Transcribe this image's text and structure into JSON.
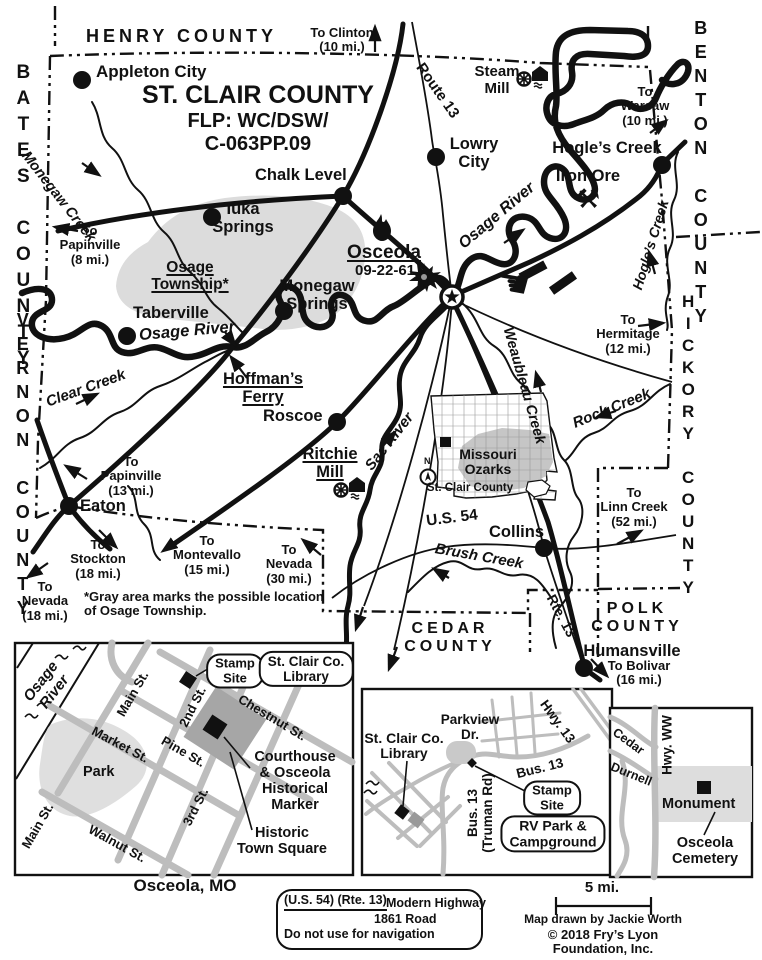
{
  "map": {
    "title": "ST. CLAIR COUNTY",
    "subtitle1": "FLP: WC/DSW/",
    "subtitle2": "C-063PP.09",
    "footnote": "*Gray area marks the possible location\nof Osage Township."
  },
  "colors": {
    "ink": "#111111",
    "township_gray": "#dcdcdc",
    "street_gray": "#bdbdbd",
    "square_gray": "#a6a6a6"
  },
  "counties": {
    "henry": "HENRY COUNTY",
    "bates": "BATES COUNTY",
    "benton": "BENTON COUNTY",
    "vernon": "VERNON COUNTY",
    "hickory": "HICKORY COUNTY",
    "cedar": "CEDAR\nCOUNTY",
    "polk": "POLK\nCOUNTY"
  },
  "towns": {
    "appleton_city": "Appleton City",
    "chalk_level": "Chalk Level",
    "lowry_city": "Lowry\nCity",
    "hogles_creek": "Hogle’s Creek",
    "iuka_springs": "Iuka\nSprings",
    "monegaw_springs": "Monegaw\nSprings",
    "taberville": "Taberville",
    "roscoe": "Roscoe",
    "eaton": "Eaton",
    "collins": "Collins",
    "humansville": "Humansville",
    "osceola": "Osceola",
    "osceola_date": "09-22-61"
  },
  "waterways": {
    "osage_river": "Osage River",
    "monegaw_creek": "Monegaw Creek",
    "clear_creek": "Clear Creek",
    "sac_river": "Sac River",
    "weaubleau_creek": "Weaubleau Creek",
    "rock_creek": "Rock Creek",
    "brush_creek": "Brush Creek",
    "hogles_creek": "Hogle’s Creek"
  },
  "roads": {
    "route_13": "Route 13",
    "us_54": "U.S. 54",
    "rte_13": "Rte. 13"
  },
  "landmarks": {
    "osage_township": "Osage\nTownship*",
    "hoffmans_ferry": "Hoffman’s\nFerry",
    "steam_mill": "Steam\nMill",
    "ritchie_mill": "Ritchie\nMill",
    "iron_ore": "Iron Ore"
  },
  "directions": {
    "clinton": "To Clinton\n(10 mi.)",
    "warsaw": "To\nWarsaw\n(10 mi.)",
    "papinville8": "To\nPapinville\n(8 mi.)",
    "hermitage": "To\nHermitage\n(12 mi.)",
    "papinville13": "To\nPapinville\n(13 mi.)",
    "linn_creek": "To\nLinn Creek\n(52 mi.)",
    "stockton": "To\nStockton\n(18 mi.)",
    "montevallo": "To\nMontevallo\n(15 mi.)",
    "nevada30": "To\nNevada\n(30 mi.)",
    "nevada18": "To\nNevada\n(18 mi.)",
    "bolivar": "To Bolivar\n(16 mi.)"
  },
  "state_inset": {
    "region": "Missouri\nOzarks",
    "county": "St. Clair County",
    "north": "N"
  },
  "town_inset": {
    "caption": "Osceola, MO",
    "river": "Osage\nRiver",
    "park": "Park",
    "stamp_site": "Stamp\nSite",
    "library": "St. Clair Co.\nLibrary",
    "courthouse": "Courthouse\n& Osceola\nHistorical\nMarker",
    "square": "Historic\nTown Square",
    "streets": {
      "main1": "Main St.",
      "main2": "Main St.",
      "second": "2nd St.",
      "third": "3rd St.",
      "market": "Market St.",
      "pine": "Pine St.",
      "chestnut": "Chestnut St.",
      "walnut": "Walnut St."
    }
  },
  "library_inset": {
    "library": "St. Clair Co.\nLibrary",
    "parkview": "Parkview\nDr.",
    "hwy13": "Hwy. 13",
    "bus13": "Bus. 13",
    "truman": "Bus. 13\n(Truman Rd)",
    "stamp_site": "Stamp\nSite",
    "rv_park": "RV Park &\nCampground"
  },
  "cemetery_inset": {
    "cedar": "Cedar",
    "durnell": "Durnell",
    "hwy_ww": "Hwy. WW",
    "monument": "Monument",
    "cemetery": "Osceola\nCemetery"
  },
  "legend": {
    "modern_symbol": "(U.S. 54) (Rte. 13)",
    "modern_label": "Modern Highway",
    "old_label": "1861 Road",
    "note": "Do not use for navigation"
  },
  "scale_label": "5 mi.",
  "credits": {
    "author": "Map drawn by Jackie Worth",
    "copyright": "© 2018 Fry’s Lyon Foundation, Inc."
  }
}
